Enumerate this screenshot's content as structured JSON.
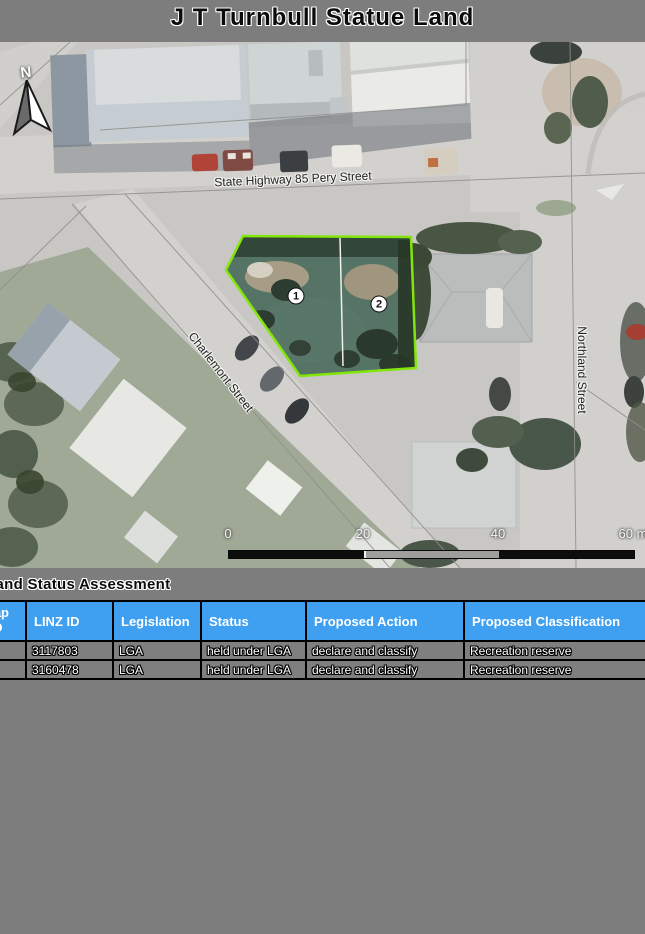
{
  "page": {
    "title": "J T Turnbull Statue Land"
  },
  "map": {
    "north_label": "N",
    "street_labels": {
      "highway": "State Highway 85 Pery Street",
      "charlemont": "Charlemont Street",
      "northland": "Northland Street"
    },
    "parcel_markers": [
      {
        "label": "1"
      },
      {
        "label": "2"
      }
    ],
    "scale_bar": {
      "ticks": [
        "0",
        "20",
        "40",
        "60 m"
      ]
    },
    "colors": {
      "parcel_outline": "#82E60A"
    }
  },
  "assessment": {
    "section_title": "Land Status Assessment",
    "colors": {
      "header_bg": "#3FA0F2"
    },
    "table": {
      "columns": [
        "Map ID",
        "LINZ ID",
        "Legislation",
        "Status",
        "Proposed Action",
        "Proposed Classification"
      ],
      "rows": [
        {
          "map_id": "",
          "linz_id": "3117803",
          "legislation": "LGA",
          "status": "held under LGA",
          "proposed_action": "declare and classify",
          "proposed_classification": "Recreation reserve"
        },
        {
          "map_id": "",
          "linz_id": "3160478",
          "legislation": "LGA",
          "status": "held under LGA",
          "proposed_action": "declare and classify",
          "proposed_classification": "Recreation reserve"
        }
      ]
    }
  }
}
